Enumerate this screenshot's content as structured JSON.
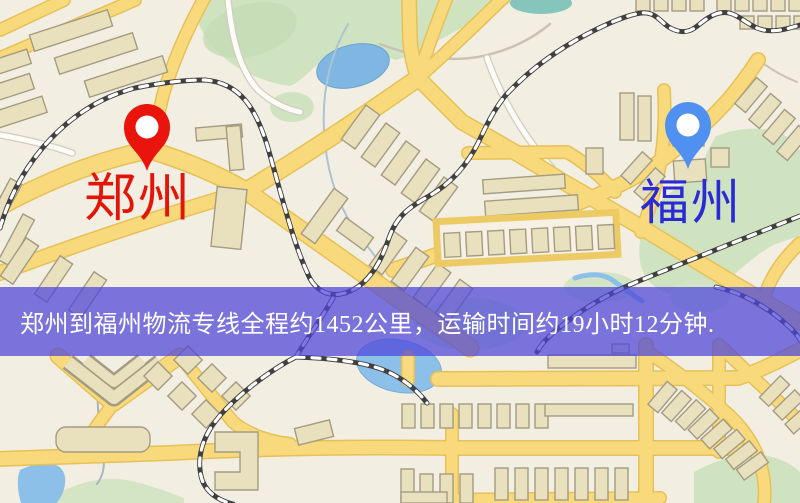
{
  "map": {
    "markers": {
      "origin": {
        "label": "郑州",
        "label_color": "#e41408",
        "pin_color": "#e9140b"
      },
      "destination": {
        "label": "福州",
        "label_color": "#2a2ad6",
        "pin_color": "#4f90f0"
      }
    },
    "banner": {
      "text": "郑州到福州物流专线全程约1452公里，运输时间约19小时12分钟.",
      "background": "#4c44da",
      "text_color": "#ffffff",
      "distance_km": "1452",
      "duration": "19小时12分钟"
    },
    "palette": {
      "map_background": "#f3eee2",
      "road_yellow": "#f8da7c",
      "road_casing": "#e6c157",
      "park_green": "#cfe3c1",
      "water_blue": "#7fb6e2",
      "building_tan": "#e9e0bd",
      "railway_dark": "#404040"
    }
  }
}
